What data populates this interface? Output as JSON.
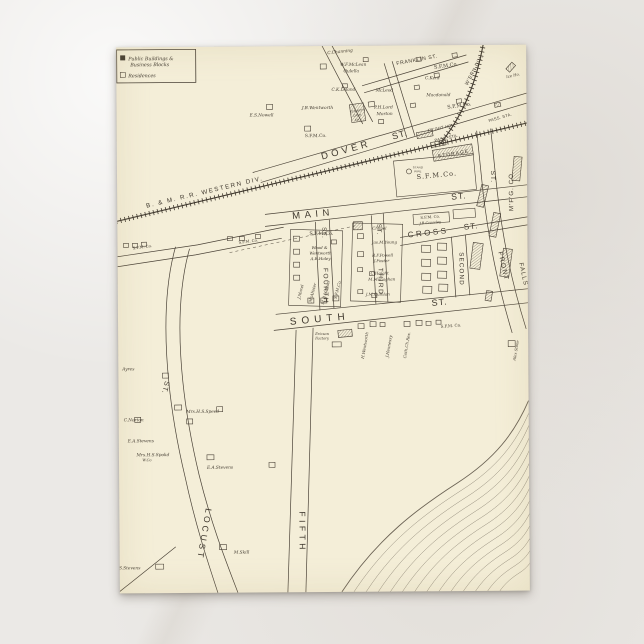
{
  "scene": {
    "background": "#ebe9e6",
    "card_color": "#f4eed8",
    "ink_color": "#3f382e"
  },
  "legend": {
    "item1_line1": "Public Buildings &",
    "item1_line2": "Business Blocks",
    "item2": "Residences"
  },
  "map": {
    "labels": [
      {
        "t": "B. & M. R.R. WESTERN DIV.",
        "x": 88,
        "y": 147,
        "r": -13,
        "s": 6.2,
        "ls": 1.6
      },
      {
        "t": "DOVER",
        "x": 230,
        "y": 107,
        "r": -15,
        "s": 9.5,
        "ls": 3.5
      },
      {
        "t": "ST.",
        "x": 284,
        "y": 92,
        "r": -15,
        "s": 9,
        "ls": 1
      },
      {
        "t": "FRANKLIN ST.",
        "x": 301,
        "y": 16,
        "r": -10,
        "s": 5.2,
        "ls": 0.6
      },
      {
        "t": "W'ERN DIV.",
        "x": 359,
        "y": 26,
        "r": -62,
        "s": 5,
        "ls": 0.6
      },
      {
        "t": "MAIN",
        "x": 196,
        "y": 171,
        "r": -5,
        "s": 9.5,
        "ls": 4.5
      },
      {
        "t": "ST.",
        "x": 342,
        "y": 154,
        "r": -5,
        "s": 8.5,
        "ls": 1
      },
      {
        "t": "CROSS",
        "x": 311,
        "y": 190,
        "r": -6,
        "s": 8,
        "ls": 2.5
      },
      {
        "t": "ST.",
        "x": 354,
        "y": 184,
        "r": -6,
        "s": 8,
        "ls": 1
      },
      {
        "t": "SOUTH",
        "x": 202,
        "y": 276,
        "r": -5,
        "s": 10,
        "ls": 5
      },
      {
        "t": "ST.",
        "x": 322,
        "y": 260,
        "r": -5,
        "s": 9,
        "ls": 1
      },
      {
        "t": "FOURTH",
        "x": 206,
        "y": 240,
        "r": 90,
        "s": 6.5,
        "ls": 1.5
      },
      {
        "t": "ST.",
        "x": 205,
        "y": 187,
        "r": 90,
        "s": 6,
        "ls": 1
      },
      {
        "t": "THIRD",
        "x": 261,
        "y": 236,
        "r": 90,
        "s": 6.5,
        "ls": 1.5
      },
      {
        "t": "ST.",
        "x": 260,
        "y": 184,
        "r": 90,
        "s": 6,
        "ls": 1
      },
      {
        "t": "SECOND",
        "x": 342,
        "y": 224,
        "r": 90,
        "s": 6.2,
        "ls": 1.2
      },
      {
        "t": "FRONT",
        "x": 384,
        "y": 222,
        "r": 78,
        "s": 6.5,
        "ls": 1.5
      },
      {
        "t": "ST.",
        "x": 374,
        "y": 132,
        "r": 90,
        "s": 6.5,
        "ls": 1
      },
      {
        "t": "M'F'G. CO.",
        "x": 396,
        "y": 146,
        "r": -90,
        "s": 6.2,
        "ls": 1
      },
      {
        "t": "FALLS",
        "x": 404,
        "y": 230,
        "r": 78,
        "s": 6.2,
        "ls": 1
      },
      {
        "t": "FIFTH",
        "x": 180,
        "y": 486,
        "r": 90,
        "s": 8.5,
        "ls": 3.5
      },
      {
        "t": "LOCUST",
        "x": 82,
        "y": 487,
        "r": 100,
        "s": 8.5,
        "ls": 3
      },
      {
        "t": "ST.",
        "x": 45,
        "y": 340,
        "r": 105,
        "s": 7,
        "ls": 1
      },
      {
        "t": "PASS. STA.",
        "x": 330,
        "y": 94,
        "r": -12,
        "s": 4,
        "ls": 0.3
      },
      {
        "t": "FR'GHT HO.",
        "x": 324,
        "y": 84,
        "r": -12,
        "s": 4,
        "ls": 0.3
      },
      {
        "t": "PASS. STA.",
        "x": 384,
        "y": 74,
        "r": -16,
        "s": 4,
        "ls": 0.3
      },
      {
        "t": "STORAGE",
        "x": 337,
        "y": 110,
        "r": -9,
        "s": 4.8,
        "ls": 1.2
      },
      {
        "t": "STAND",
        "x": 301,
        "y": 123,
        "r": 0,
        "s": 2.8,
        "ls": 0.2
      },
      {
        "t": "PIPE",
        "x": 301,
        "y": 127,
        "r": 0,
        "s": 2.8,
        "ls": 0.2
      },
      {
        "t": "ST.MARY'S",
        "x": 241,
        "y": 66,
        "r": -8,
        "s": 3,
        "ls": 0
      },
      {
        "t": "CATH.",
        "x": 241,
        "y": 70.5,
        "r": -8,
        "s": 3,
        "ls": 0
      },
      {
        "t": "CH.",
        "x": 241,
        "y": 75,
        "r": -8,
        "s": 3,
        "ls": 0
      },
      {
        "t": "S.F.M.Co.",
        "x": 330,
        "y": 22,
        "r": -8,
        "s": 5,
        "f": 1
      },
      {
        "t": "S.F.M.Co.",
        "x": 343,
        "y": 62,
        "r": -8,
        "s": 5,
        "f": 1
      },
      {
        "t": "S.F.M.Co.",
        "x": 199,
        "y": 91,
        "r": 0,
        "s": 4.5,
        "f": 1
      },
      {
        "t": "S.F.M.Co.",
        "x": 320,
        "y": 132,
        "r": -5,
        "s": 6.5,
        "ls": 1,
        "f": 1
      },
      {
        "t": "S.F.M.Co.",
        "x": 204,
        "y": 189,
        "r": 0,
        "s": 5,
        "f": 1
      },
      {
        "t": "S.F.M. Co.",
        "x": 313,
        "y": 173,
        "r": -4,
        "s": 3.8,
        "f": 1
      },
      {
        "t": "J.B.Crossley",
        "x": 313,
        "y": 178.5,
        "r": -4,
        "s": 3.6,
        "i": 1
      },
      {
        "t": "S.F.M. Co.",
        "x": 25,
        "y": 201,
        "r": -7,
        "s": 3.8,
        "f": 1
      },
      {
        "t": "S.F.M. Co.",
        "x": 131,
        "y": 196,
        "r": -7,
        "s": 3.8,
        "f": 1
      },
      {
        "t": "S.F.M. Co.",
        "x": 333,
        "y": 282,
        "r": -4,
        "s": 4,
        "f": 1
      },
      {
        "t": "C.Channing",
        "x": 224,
        "y": 7,
        "r": -6,
        "s": 4.3,
        "i": 1
      },
      {
        "t": "W.F.McLean",
        "x": 237,
        "y": 20,
        "s": 4.3,
        "i": 1
      },
      {
        "t": "Oulella",
        "x": 235,
        "y": 26.5,
        "s": 4.3,
        "i": 1
      },
      {
        "t": "C.K.Leland",
        "x": 227,
        "y": 45,
        "s": 4.3,
        "i": 1
      },
      {
        "t": "McLeod",
        "x": 268,
        "y": 46,
        "s": 4.3,
        "i": 1
      },
      {
        "t": "C.Kent",
        "x": 316,
        "y": 34,
        "s": 4.3,
        "i": 1
      },
      {
        "t": "Macdonald",
        "x": 322,
        "y": 51,
        "s": 4.3,
        "i": 1
      },
      {
        "t": "J.B.Wentworth",
        "x": 201,
        "y": 63,
        "s": 4.3,
        "i": 1
      },
      {
        "t": "P.H.Lord",
        "x": 267,
        "y": 63,
        "s": 4.3,
        "i": 1
      },
      {
        "t": "Morton",
        "x": 268,
        "y": 69.5,
        "s": 4.3,
        "i": 1
      },
      {
        "t": "E.S.Nowell",
        "x": 145,
        "y": 70,
        "s": 4.3,
        "i": 1
      },
      {
        "t": "Ice Ho.",
        "x": 397,
        "y": 32,
        "r": -12,
        "s": 3.8,
        "i": 1
      },
      {
        "t": "Chapel",
        "x": 262,
        "y": 184,
        "s": 4,
        "i": 1
      },
      {
        "t": "Jas.M.Young",
        "x": 267,
        "y": 198,
        "s": 4,
        "i": 1
      },
      {
        "t": "R.F.Powell",
        "x": 265,
        "y": 211,
        "s": 4,
        "i": 1
      },
      {
        "t": "J.Foster",
        "x": 264,
        "y": 216.5,
        "s": 4,
        "i": 1
      },
      {
        "t": "C.Haight",
        "x": 262,
        "y": 229,
        "s": 4,
        "i": 1
      },
      {
        "t": "M.Monaghan",
        "x": 264,
        "y": 235,
        "s": 4,
        "i": 1
      },
      {
        "t": "J.M.Quinlan",
        "x": 260,
        "y": 250,
        "s": 4,
        "i": 1
      },
      {
        "t": "Wood &",
        "x": 202,
        "y": 203,
        "s": 4,
        "i": 1
      },
      {
        "t": "Wentworth",
        "x": 203,
        "y": 208.5,
        "s": 4,
        "i": 1
      },
      {
        "t": "A.B.Haley",
        "x": 203,
        "y": 214,
        "s": 4,
        "i": 1
      },
      {
        "t": "J.Morel",
        "x": 184,
        "y": 246,
        "r": -75,
        "s": 4,
        "i": 1
      },
      {
        "t": "McAlister",
        "x": 196,
        "y": 247,
        "r": -75,
        "s": 4,
        "i": 1
      },
      {
        "t": "M.B.Horton",
        "x": 209,
        "y": 247,
        "r": -75,
        "s": 4,
        "i": 1
      },
      {
        "t": "S.F.M.Co.",
        "x": 221,
        "y": 244,
        "r": -75,
        "s": 4,
        "i": 1
      },
      {
        "t": "Ericson",
        "x": 204,
        "y": 289,
        "s": 3.6,
        "i": 1
      },
      {
        "t": "Factory",
        "x": 204,
        "y": 293.5,
        "s": 3.6,
        "i": 1
      },
      {
        "t": "H.Wentworth",
        "x": 248,
        "y": 300,
        "r": -80,
        "s": 4,
        "i": 1
      },
      {
        "t": "J.Hennessy",
        "x": 272,
        "y": 301,
        "r": -80,
        "s": 4,
        "i": 1
      },
      {
        "t": "Cath.Ch.Res.",
        "x": 290,
        "y": 300,
        "r": -80,
        "s": 4,
        "i": 1
      },
      {
        "t": "Alex Stone",
        "x": 399,
        "y": 306,
        "r": -80,
        "s": 3.8,
        "i": 1
      },
      {
        "t": "Ayres",
        "x": 10,
        "y": 323,
        "s": 4.3,
        "i": 1
      },
      {
        "t": "Mrs.H.S.Speed",
        "x": 84,
        "y": 366,
        "s": 4.3,
        "i": 1
      },
      {
        "t": "C.Norton",
        "x": 15,
        "y": 374,
        "s": 4.3,
        "i": 1
      },
      {
        "t": "E.A.Stevens",
        "x": 22,
        "y": 395,
        "s": 4.3,
        "i": 1
      },
      {
        "t": "Mrs.H.S.Spokd",
        "x": 34,
        "y": 409,
        "s": 4.3,
        "i": 1
      },
      {
        "t": "W.Co",
        "x": 28,
        "y": 414,
        "s": 3.6,
        "i": 1
      },
      {
        "t": "E.A.Stevens",
        "x": 101,
        "y": 422,
        "s": 4.3,
        "i": 1
      },
      {
        "t": "M.Skill",
        "x": 122,
        "y": 507,
        "s": 4.3,
        "i": 1
      },
      {
        "t": "S.Stevens",
        "x": 10,
        "y": 522,
        "s": 4.3,
        "i": 1
      }
    ],
    "buildings": [
      [
        204,
        18,
        6,
        5,
        0,
        0
      ],
      [
        247,
        12,
        5,
        4,
        0,
        0
      ],
      [
        150,
        58,
        6,
        5,
        0,
        0
      ],
      [
        188,
        80,
        6,
        5,
        0,
        0
      ],
      [
        226,
        38,
        5,
        4,
        0,
        0
      ],
      [
        252,
        56,
        6,
        5,
        0,
        -8
      ],
      [
        262,
        74,
        5,
        4,
        0,
        0
      ],
      [
        298,
        40,
        5,
        4,
        0,
        -8
      ],
      [
        294,
        58,
        5,
        4,
        0,
        -8
      ],
      [
        318,
        28,
        5,
        4,
        0,
        -8
      ],
      [
        340,
        54,
        5,
        4,
        0,
        -8
      ],
      [
        300,
        12,
        5,
        4,
        0,
        -8
      ],
      [
        336,
        8,
        5,
        4,
        0,
        -8
      ],
      [
        390,
        20,
        9,
        5,
        1,
        -48
      ],
      [
        378,
        58,
        6,
        4,
        1,
        -12
      ],
      [
        234,
        58,
        14,
        18,
        1,
        -8
      ],
      [
        316,
        102,
        40,
        11,
        1,
        -9
      ],
      [
        278,
        112,
        80,
        36,
        0,
        -5
      ],
      [
        300,
        86,
        16,
        6,
        1,
        -10
      ],
      [
        314,
        96,
        15,
        5,
        0,
        -10
      ],
      [
        172,
        184,
        52,
        76,
        0,
        2
      ],
      [
        176,
        190,
        6,
        5,
        0,
        0
      ],
      [
        176,
        203,
        6,
        5,
        0,
        0
      ],
      [
        176,
        216,
        6,
        5,
        0,
        0
      ],
      [
        176,
        229,
        6,
        5,
        0,
        0
      ],
      [
        190,
        252,
        6,
        5,
        0,
        0
      ],
      [
        203,
        252,
        6,
        5,
        0,
        0
      ],
      [
        215,
        250,
        6,
        5,
        0,
        0
      ],
      [
        214,
        194,
        5,
        4,
        0,
        0
      ],
      [
        234,
        178,
        50,
        78,
        0,
        2
      ],
      [
        240,
        188,
        6,
        5,
        0,
        0
      ],
      [
        236,
        176,
        9,
        8,
        1,
        0
      ],
      [
        240,
        206,
        6,
        5,
        0,
        0
      ],
      [
        240,
        222,
        5,
        4,
        0,
        0
      ],
      [
        252,
        226,
        5,
        4,
        0,
        0
      ],
      [
        240,
        244,
        5,
        4,
        0,
        0
      ],
      [
        254,
        248,
        5,
        4,
        0,
        0
      ],
      [
        296,
        168,
        36,
        10,
        0,
        -4
      ],
      [
        336,
        164,
        22,
        9,
        0,
        -4
      ],
      [
        304,
        200,
        9,
        7,
        0,
        2
      ],
      [
        320,
        198,
        9,
        7,
        0,
        2
      ],
      [
        304,
        214,
        9,
        7,
        0,
        2
      ],
      [
        320,
        212,
        9,
        7,
        0,
        2
      ],
      [
        304,
        228,
        9,
        7,
        0,
        2
      ],
      [
        320,
        226,
        9,
        7,
        0,
        2
      ],
      [
        305,
        241,
        9,
        7,
        0,
        2
      ],
      [
        321,
        239,
        9,
        7,
        0,
        2
      ],
      [
        354,
        198,
        10,
        26,
        1,
        8
      ],
      [
        240,
        278,
        6,
        5,
        0,
        0
      ],
      [
        252,
        276,
        6,
        5,
        0,
        0
      ],
      [
        262,
        277,
        5,
        4,
        0,
        0
      ],
      [
        286,
        276,
        6,
        5,
        0,
        0
      ],
      [
        298,
        275,
        6,
        5,
        0,
        0
      ],
      [
        308,
        276,
        5,
        4,
        0,
        0
      ],
      [
        318,
        275,
        5,
        4,
        0,
        0
      ],
      [
        220,
        284,
        14,
        7,
        1,
        -5
      ],
      [
        214,
        296,
        9,
        5,
        0,
        0
      ],
      [
        44,
        326,
        6,
        5,
        0,
        0
      ],
      [
        56,
        358,
        7,
        5,
        0,
        0
      ],
      [
        68,
        372,
        6,
        5,
        0,
        0
      ],
      [
        98,
        360,
        6,
        5,
        0,
        0
      ],
      [
        88,
        408,
        7,
        5,
        0,
        0
      ],
      [
        150,
        416,
        6,
        5,
        0,
        0
      ],
      [
        16,
        370,
        6,
        5,
        0,
        0
      ],
      [
        6,
        196,
        5,
        4,
        0,
        0
      ],
      [
        15,
        196,
        5,
        4,
        0,
        0
      ],
      [
        24,
        195,
        5,
        4,
        0,
        0
      ],
      [
        110,
        190,
        5,
        4,
        0,
        0
      ],
      [
        122,
        190,
        5,
        4,
        0,
        0
      ],
      [
        138,
        188,
        5,
        4,
        0,
        0
      ],
      [
        362,
        140,
        7,
        22,
        1,
        14
      ],
      [
        374,
        168,
        7,
        24,
        1,
        12
      ],
      [
        384,
        204,
        9,
        28,
        1,
        8
      ],
      [
        396,
        112,
        8,
        24,
        1,
        6
      ],
      [
        368,
        246,
        6,
        10,
        1,
        10
      ],
      [
        390,
        296,
        7,
        6,
        0,
        0
      ],
      [
        100,
        498,
        7,
        5,
        0,
        0
      ],
      [
        36,
        517,
        8,
        5,
        0,
        0
      ]
    ]
  }
}
